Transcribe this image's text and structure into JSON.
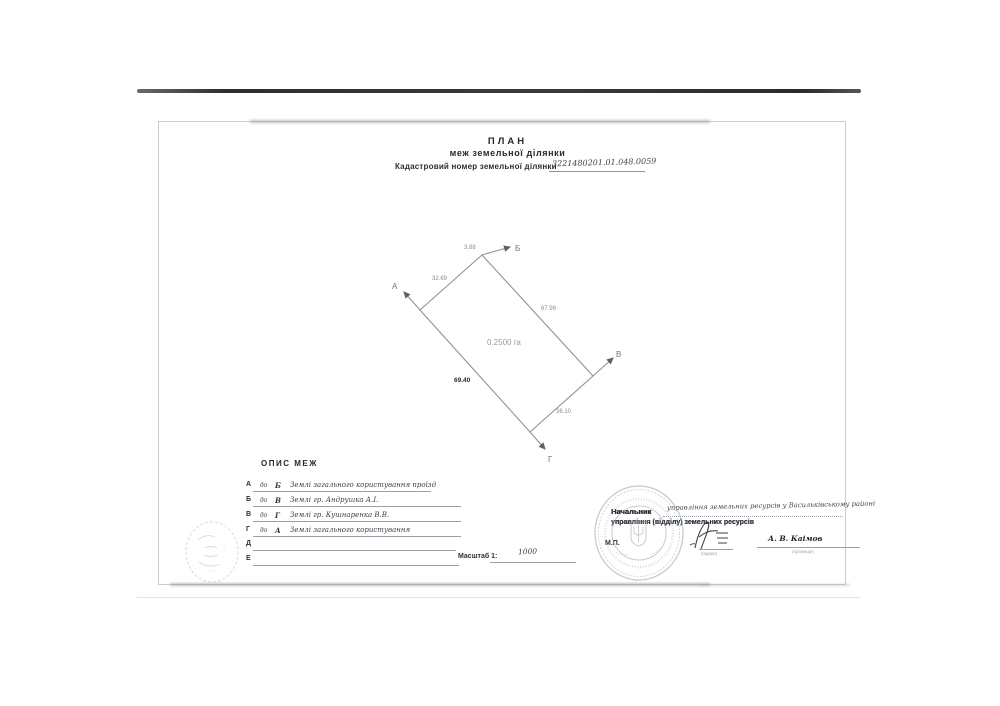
{
  "document": {
    "title": "ПЛАН",
    "subtitle": "меж земельної ділянки",
    "cadastral": {
      "label": "Кадастровий номер земельної ділянки",
      "number": "3221480201.01.048.0059"
    }
  },
  "plan_diagram": {
    "area": "0.2500 га",
    "vertices": {
      "a": "А",
      "b": "Б",
      "v": "В",
      "g": "Г"
    },
    "lengths": {
      "a_bend": "32.69",
      "bend_b": "3.88",
      "b_v": "67.99",
      "v_g": "36.10",
      "g_a": "69.40"
    }
  },
  "boundaries": {
    "heading": "ОПИС МЕЖ",
    "rows": [
      {
        "from": "А",
        "prep": "до",
        "to": "Б",
        "description": "Землі загального користування  проїзд"
      },
      {
        "from": "Б",
        "prep": "до",
        "to": "В",
        "description": "Землі гр. Андрушка А.І."
      },
      {
        "from": "В",
        "prep": "до",
        "to": "Г",
        "description": "Землі гр. Кушнаренка В.В."
      },
      {
        "from": "Г",
        "prep": "до",
        "to": "А",
        "description": "Землі загального користування"
      },
      {
        "from": "Д",
        "prep": "",
        "to": "",
        "description": ""
      },
      {
        "from": "Е",
        "prep": "",
        "to": "",
        "description": ""
      }
    ],
    "scale_label": "Масштаб 1:",
    "scale_value": "1000"
  },
  "approval": {
    "role_printed_1": "Начальник",
    "role_handwritten": "управління земельних ресурсів у Васильківському районі",
    "role_printed_2": "управління (відділу) земельних ресурсів",
    "seal_mark": "М.П.",
    "signature_caption": "(підпис)",
    "name": "А. В. Каімов",
    "name_caption": "(прізвище)"
  }
}
